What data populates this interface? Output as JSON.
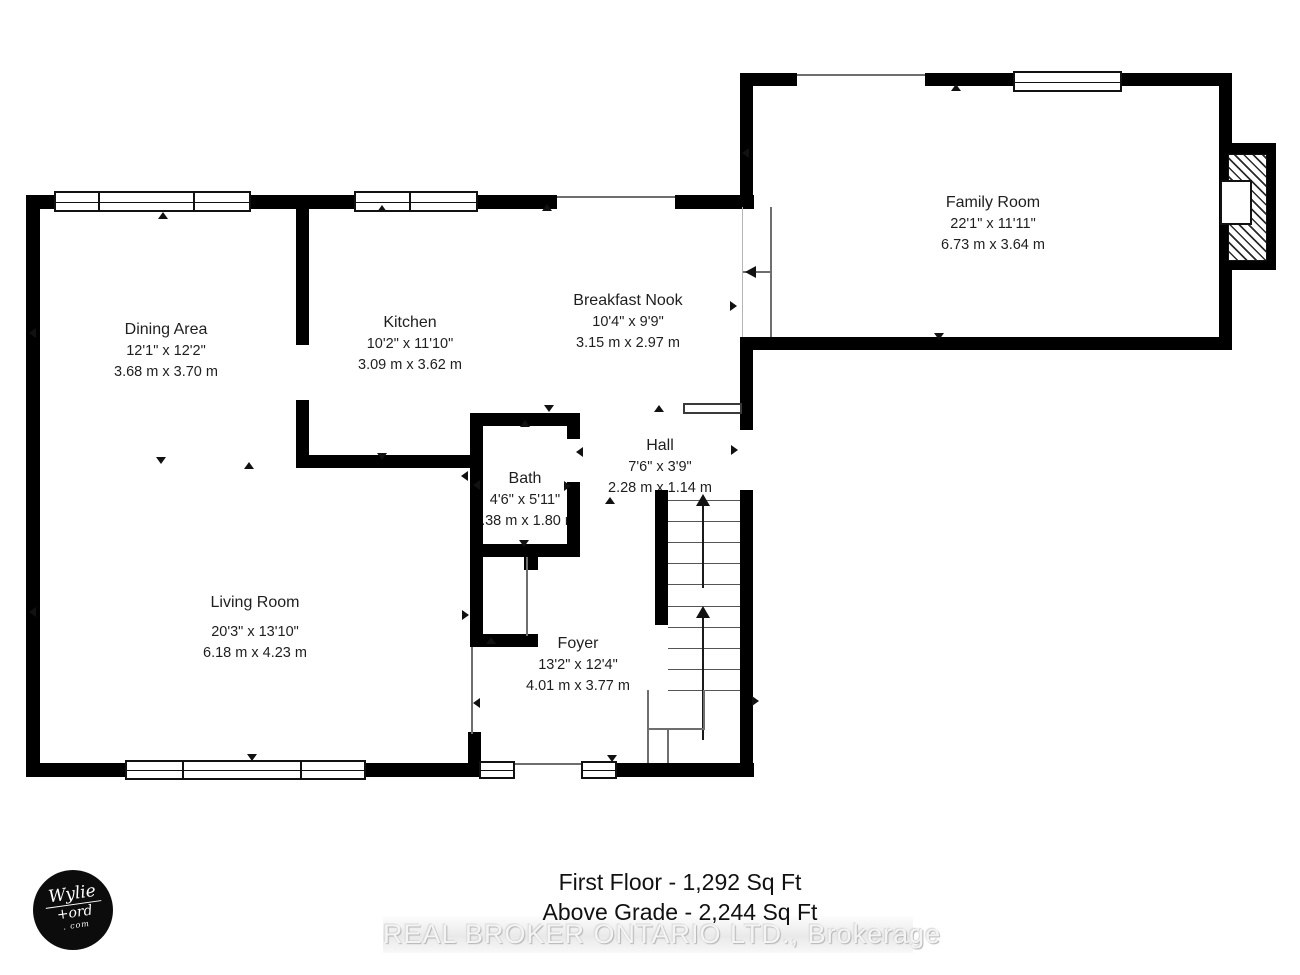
{
  "plan_title": "First Floor Plan",
  "rooms": {
    "family_room": {
      "name": "Family Room",
      "ft": "22'1\" x 11'11\"",
      "m": "6.73 m x 3.64 m"
    },
    "dining_area": {
      "name": "Dining Area",
      "ft": "12'1\" x 12'2\"",
      "m": "3.68 m x 3.70 m"
    },
    "kitchen": {
      "name": "Kitchen",
      "ft": "10'2\" x 11'10\"",
      "m": "3.09 m x 3.62 m"
    },
    "breakfast_nook": {
      "name": "Breakfast Nook",
      "ft": "10'4\" x 9'9\"",
      "m": "3.15 m x 2.97 m"
    },
    "hall": {
      "name": "Hall",
      "ft": "7'6\" x 3'9\"",
      "m": "2.28 m x 1.14 m"
    },
    "bath": {
      "name": "Bath",
      "ft": "4'6\" x 5'11\"",
      "m": "1.38 m x 1.80 m"
    },
    "living_room": {
      "name": "Living Room",
      "ft": "20'3\" x 13'10\"",
      "m": "6.18 m x 4.23 m"
    },
    "foyer": {
      "name": "Foyer",
      "ft": "13'2\" x 12'4\"",
      "m": "4.01 m x 3.77 m"
    }
  },
  "footer": {
    "line1": "First Floor - 1,292 Sq Ft",
    "line2": "Above Grade - 2,244 Sq Ft"
  },
  "watermark": "REAL BROKER ONTARIO LTD., Brokerage",
  "logo": {
    "top": "Wylie",
    "mid": "+ord",
    "bottom": ". com"
  },
  "colors": {
    "wall": "#000000",
    "text": "#1f1f1f",
    "watermark_band": "#ececec"
  }
}
